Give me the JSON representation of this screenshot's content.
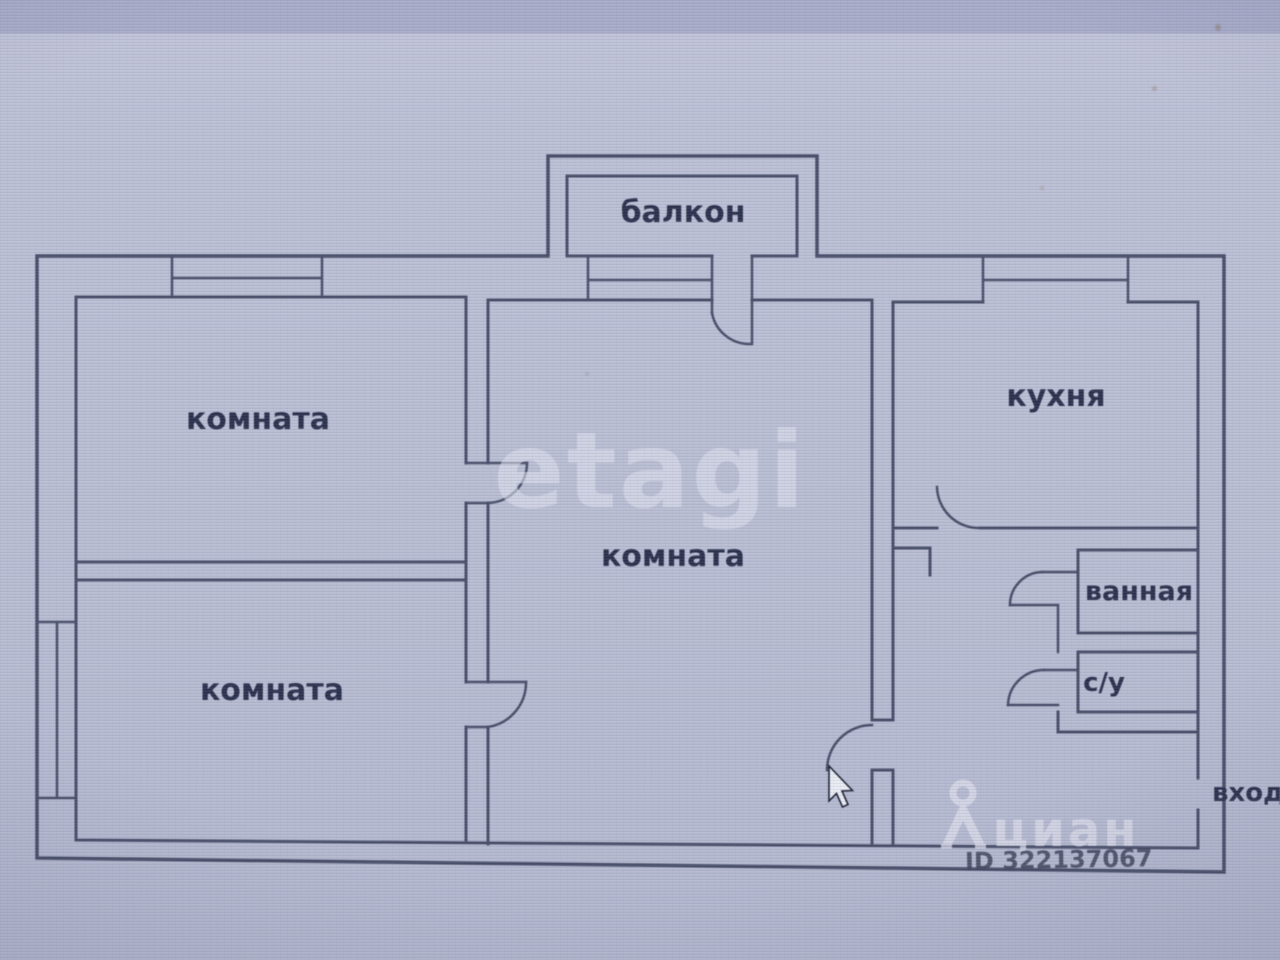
{
  "plan": {
    "type": "apartment-floor-plan",
    "rooms": [
      {
        "name": "balcony",
        "label": "балкон"
      },
      {
        "name": "room-top-left",
        "label": "комната"
      },
      {
        "name": "room-center",
        "label": "комната"
      },
      {
        "name": "room-bottom-left",
        "label": "комната"
      },
      {
        "name": "kitchen",
        "label": "кухня"
      },
      {
        "name": "bathroom",
        "label": "ванная"
      },
      {
        "name": "toilet",
        "label": "с/у"
      }
    ],
    "entrance_label": "вход",
    "watermarks": {
      "center_logo": "etagi",
      "brand": "циан",
      "listing_id": "ID 322137067"
    },
    "colors": {
      "background": "#b2b6cd",
      "top_band": "#a7abc8",
      "wall": "#454b66",
      "label": "#272d49",
      "watermark": "#dfe1ee",
      "listing_id_text": "#3c4158"
    }
  }
}
